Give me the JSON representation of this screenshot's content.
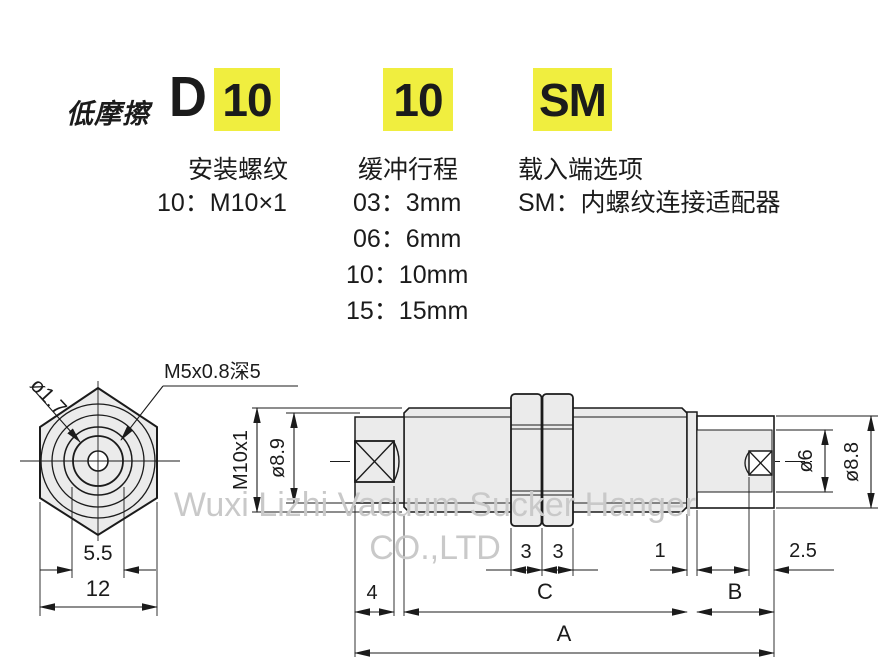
{
  "model_code": {
    "prefix": "低摩擦",
    "series": "D",
    "code_mount": "10",
    "code_stroke": "10",
    "code_end": "SM",
    "highlight_color": "#f0ee3f"
  },
  "columns": [
    {
      "title": "安装螺纹",
      "lines": [
        "10：M10×1"
      ]
    },
    {
      "title": "缓冲行程",
      "lines": [
        "03：3mm",
        "06：6mm",
        "10：10mm",
        "15：15mm"
      ]
    },
    {
      "title": "载入端选项",
      "lines": [
        "SM：内螺纹连接适配器"
      ]
    }
  ],
  "dims": {
    "front": {
      "hole": "ø1.7",
      "thread": "M5x0.8深5",
      "flats_inner": "5.5",
      "flats": "12"
    },
    "side": {
      "mount": "M10x1",
      "body": "ø8.9",
      "nut1": "3",
      "nut2": "3",
      "step": "1",
      "tip": "2.5",
      "bore": "ø6",
      "cap": "ø8.8",
      "rod": "4",
      "body_len": "C",
      "cap_len": "B",
      "total": "A"
    }
  },
  "watermark": {
    "line1": "Wuxi Lizhi Vacuum Sucker Hanger",
    "line2": "CO.,LTD"
  }
}
